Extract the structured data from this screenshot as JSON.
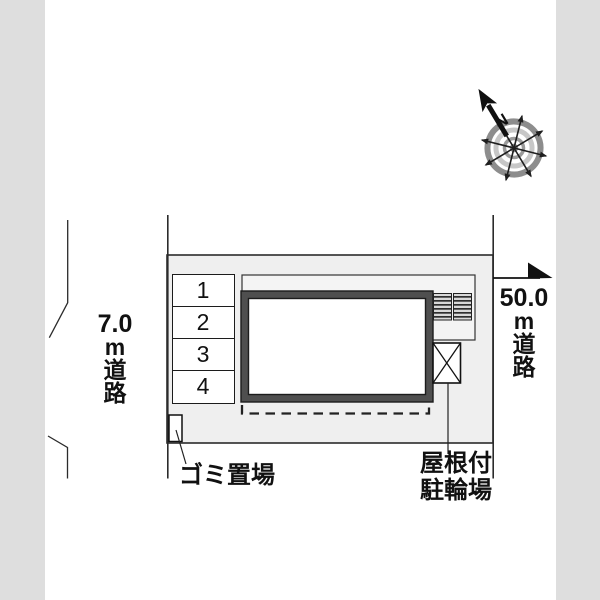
{
  "plan": {
    "type": "site-plan",
    "compass": {
      "north_label": "N"
    },
    "roads": {
      "left": {
        "width": "7.0",
        "unit": "m",
        "name": "道路",
        "lines": [
          "7.0",
          "m",
          "道",
          "路"
        ]
      },
      "right": {
        "width": "50.0",
        "unit": "m",
        "name": "道路",
        "lines": [
          "50.0",
          "m",
          "道",
          "路"
        ]
      }
    },
    "parking": {
      "spaces": [
        {
          "label": "1"
        },
        {
          "label": "2"
        },
        {
          "label": "3"
        },
        {
          "label": "4"
        }
      ]
    },
    "annotations": {
      "trash": "ゴミ置場",
      "bike_shed_line1": "屋根付",
      "bike_shed_line2": "駐輪場"
    },
    "colors": {
      "side_band": "#dedede",
      "plot_fill": "#efefef",
      "bike_area_fill": "#f4f4f4",
      "building_frame": "#4f4f4f",
      "line": "#1a1a1a",
      "compass_outer_ring": "#8d8d8d",
      "compass_mid_ring": "#c7c7c7",
      "compass_inner_ring": "#9b9b9b"
    }
  }
}
